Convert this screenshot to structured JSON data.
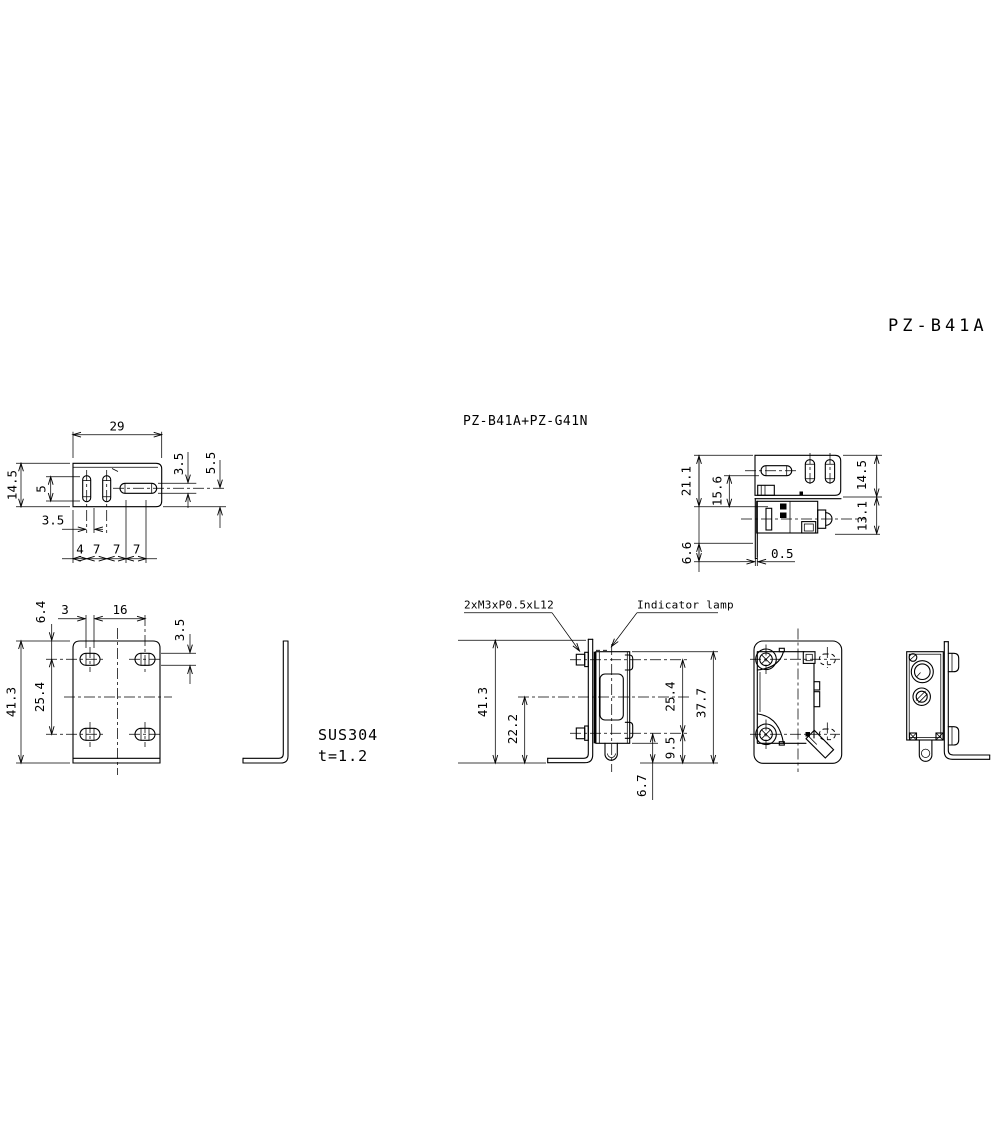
{
  "drawing": {
    "title": "PZ-B41A",
    "assembly_label": "PZ-B41A+PZ-G41N",
    "material": {
      "name": "SUS304",
      "thickness": "t=1.2"
    },
    "callouts": {
      "screws": "2xM3xP0.5xL12",
      "indicator": "Indicator lamp"
    },
    "views": {
      "bracket_top": {
        "dims": {
          "width": "29",
          "depth": "14.5",
          "slot_length": "5",
          "slot_offset": "3.5",
          "pitch": [
            "4",
            "7",
            "7",
            "7"
          ],
          "slot_width": "3.5",
          "edge_to_slot": "5.5"
        }
      },
      "bracket_front": {
        "dims": {
          "top_to_hole": "6.4",
          "slot_travel": "3",
          "hole_pitch_x": "16",
          "hole_width": "3.5",
          "height": "41.3",
          "hole_pitch_y": "25.4"
        }
      },
      "assembly_top": {
        "dims": {
          "overall_depth": "21.1",
          "axis_depth": "15.6",
          "plate_depth": "14.5",
          "sensor_depth": "13.1",
          "leg_below": "6.6",
          "gap": "0.5"
        }
      },
      "assembly_front": {
        "dims": {
          "height": "41.3",
          "axis_to_bottom": "22.2",
          "screw_pitch": "25.4",
          "sensor_height": "37.7",
          "screw_to_bottom": "9.5",
          "cable_clearance": "6.7"
        }
      }
    }
  }
}
